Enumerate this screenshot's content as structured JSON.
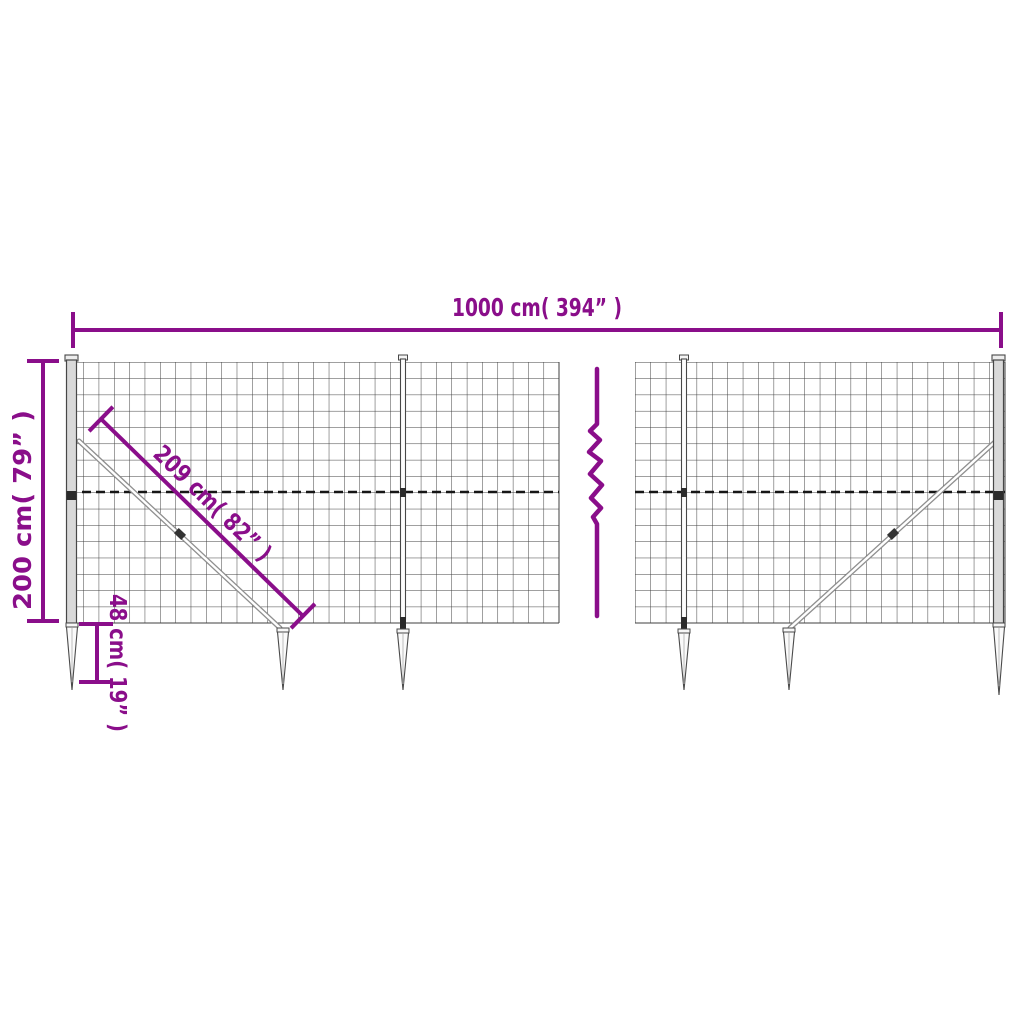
{
  "diagram": {
    "title": "wire-mesh-fence-dimension-diagram",
    "background_color": "#ffffff",
    "accent_color": "#8a0e8a",
    "mesh_color": "#3f3f3f",
    "dimensions": {
      "width": {
        "label": "1000 cm( 394” )"
      },
      "height": {
        "label": "200 cm( 79” )"
      },
      "brace": {
        "label": "209 cm( 82” )"
      },
      "anchor_depth": {
        "label": "48 cm( 19” )"
      }
    }
  }
}
